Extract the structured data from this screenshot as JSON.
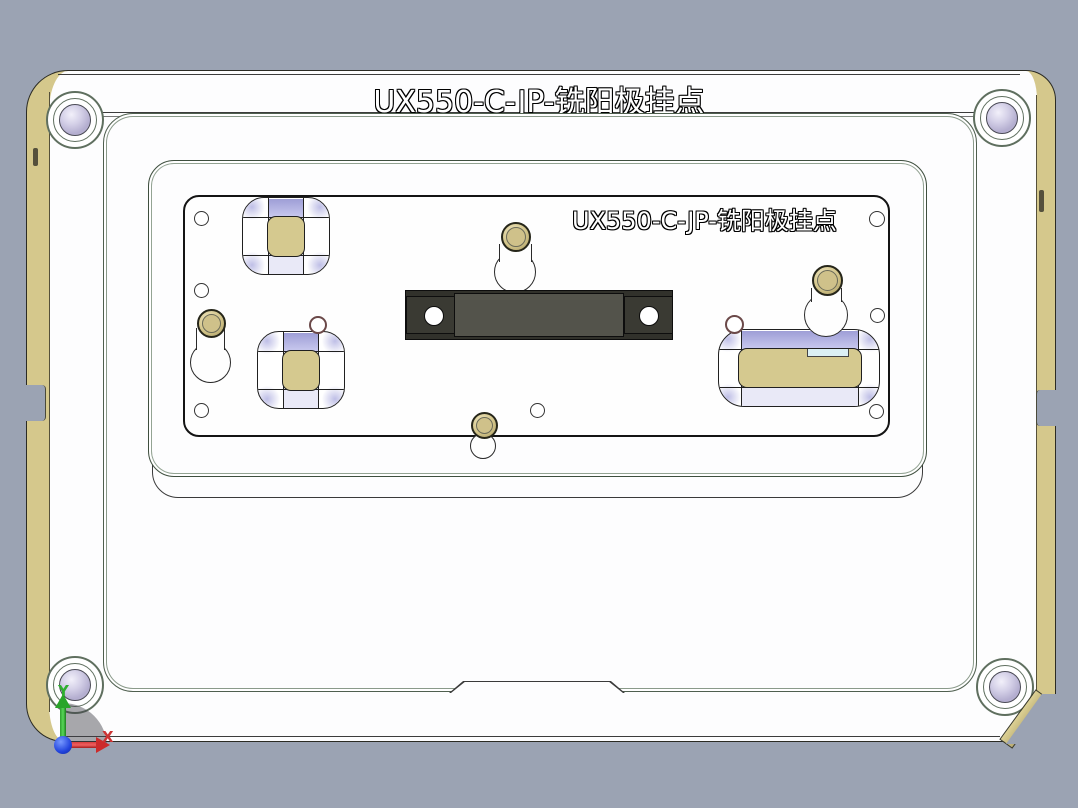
{
  "scene": {
    "description": "CAD top view of a milling fixture plate",
    "background_color": "#9ba3b3"
  },
  "titles": {
    "top": "UX550-C-JP-铣阳极挂点",
    "engraved": "UX550-C-JP-铣阳极挂点"
  },
  "axis_triad": {
    "x_label": "X",
    "y_label": "Y",
    "x_color": "#cc3434",
    "y_color": "#2fae2f",
    "origin_color": "#2244dd"
  },
  "colors": {
    "plate_face": "#fdfdfe",
    "side_wall_tan": "#d5c88c",
    "pocket_insert_tan": "#d5c98f",
    "pocket_shade_lavender": "#a9a9dc",
    "clamp_bar_dark": "#31312b",
    "clamp_bar_center": "#53534b",
    "washer_lavender": "#c0bbd9",
    "pin_gold": "#d2c489",
    "cyan_notch": "#dcf0f4"
  },
  "features": {
    "corner_washers": 4,
    "gold_pins": 4,
    "keyhole_slots": 4,
    "pockets": 3,
    "small_holes": 7,
    "clamp_bar_holes": 2
  }
}
